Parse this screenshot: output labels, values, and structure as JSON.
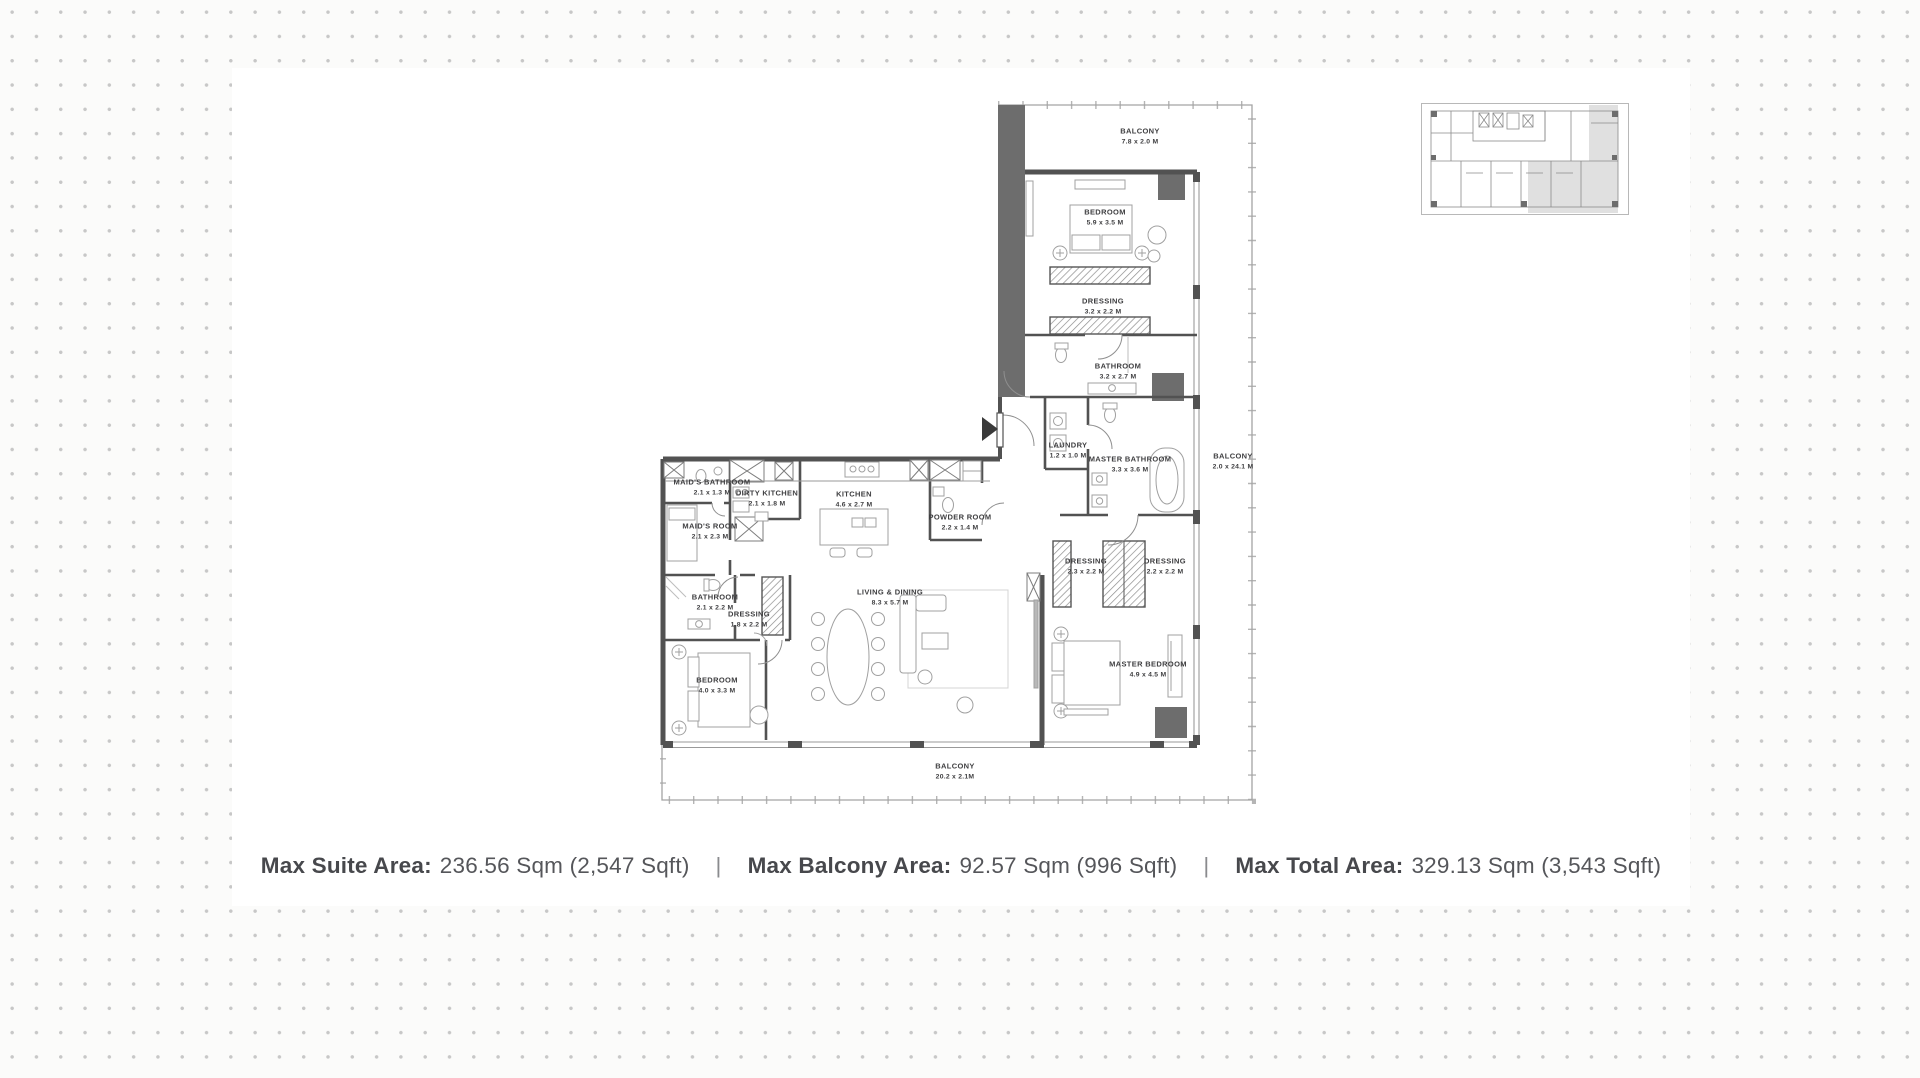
{
  "page": {
    "background_dot_color": "#c7c7c7",
    "panel_color": "#ffffff",
    "wall_color": "#525252",
    "highlight_color": "#d6d6d6",
    "label_text_color": "#3e3e40",
    "summary_text_color": "#55565a"
  },
  "floorplan": {
    "rooms": [
      {
        "id": "balcony-top",
        "name": "BALCONY",
        "dims": "7.8 x 2.0 M",
        "x": 480,
        "y": 52
      },
      {
        "id": "bedroom-top",
        "name": "BEDROOM",
        "dims": "5.9 x 3.5 M",
        "x": 445,
        "y": 133
      },
      {
        "id": "dressing-top",
        "name": "DRESSING",
        "dims": "3.2 x 2.2 M",
        "x": 443,
        "y": 222
      },
      {
        "id": "bathroom-top",
        "name": "BATHROOM",
        "dims": "3.2 x 2.7 M",
        "x": 458,
        "y": 287
      },
      {
        "id": "laundry",
        "name": "LAUNDRY",
        "dims": "1.2 x 1.0 M",
        "x": 408,
        "y": 366
      },
      {
        "id": "master-bathroom",
        "name": "MASTER BATHROOM",
        "dims": "3.3 x 3.6 M",
        "x": 470,
        "y": 380
      },
      {
        "id": "balcony-right",
        "name": "BALCONY",
        "dims": "2.0 x 24.1 M",
        "x": 573,
        "y": 377
      },
      {
        "id": "maids-bathroom",
        "name": "MAID'S BATHROOM",
        "dims": "2.1 x 1.3 M",
        "x": 52,
        "y": 403
      },
      {
        "id": "dirty-kitchen",
        "name": "DIRTY KITCHEN",
        "dims": "2.1 x 1.8 M",
        "x": 107,
        "y": 414
      },
      {
        "id": "kitchen",
        "name": "KITCHEN",
        "dims": "4.6 x 2.7 M",
        "x": 194,
        "y": 415
      },
      {
        "id": "maids-room",
        "name": "MAID'S ROOM",
        "dims": "2.1 x 2.3 M",
        "x": 50,
        "y": 447
      },
      {
        "id": "powder-room",
        "name": "POWDER ROOM",
        "dims": "2.2 x 1.4 M",
        "x": 300,
        "y": 438
      },
      {
        "id": "bathroom-2",
        "name": "BATHROOM",
        "dims": "2.1 x 2.2 M",
        "x": 55,
        "y": 518
      },
      {
        "id": "dressing-2",
        "name": "DRESSING",
        "dims": "1.8 x 2.2 M",
        "x": 89,
        "y": 535
      },
      {
        "id": "living-dining",
        "name": "LIVING & DINING",
        "dims": "8.3 x 5.7 M",
        "x": 230,
        "y": 513
      },
      {
        "id": "dressing-3",
        "name": "DRESSING",
        "dims": "2.3 x 2.2 M",
        "x": 426,
        "y": 482
      },
      {
        "id": "dressing-4",
        "name": "DRESSING",
        "dims": "2.2 x 2.2 M",
        "x": 505,
        "y": 482
      },
      {
        "id": "bedroom-2",
        "name": "BEDROOM",
        "dims": "4.0 x 3.3 M",
        "x": 57,
        "y": 601
      },
      {
        "id": "master-bedroom",
        "name": "MASTER BEDROOM",
        "dims": "4.9 x 4.5 M",
        "x": 488,
        "y": 585
      },
      {
        "id": "balcony-bottom",
        "name": "BALCONY",
        "dims": "20.2 x 2.1M",
        "x": 295,
        "y": 687
      }
    ],
    "icons": [
      {
        "name": "entry-arrow-icon",
        "meaning": "unit entrance direction"
      }
    ]
  },
  "keyplan": {
    "name": "floor key plan",
    "highlighted_unit": "current unit (shaded)"
  },
  "summary": {
    "separator": "|",
    "items": [
      {
        "label": "Max Suite Area:",
        "value": "236.56 Sqm (2,547 Sqft)"
      },
      {
        "label": "Max Balcony Area:",
        "value": "92.57 Sqm (996 Sqft)"
      },
      {
        "label": "Max Total Area:",
        "value": "329.13 Sqm (3,543 Sqft)"
      }
    ]
  }
}
